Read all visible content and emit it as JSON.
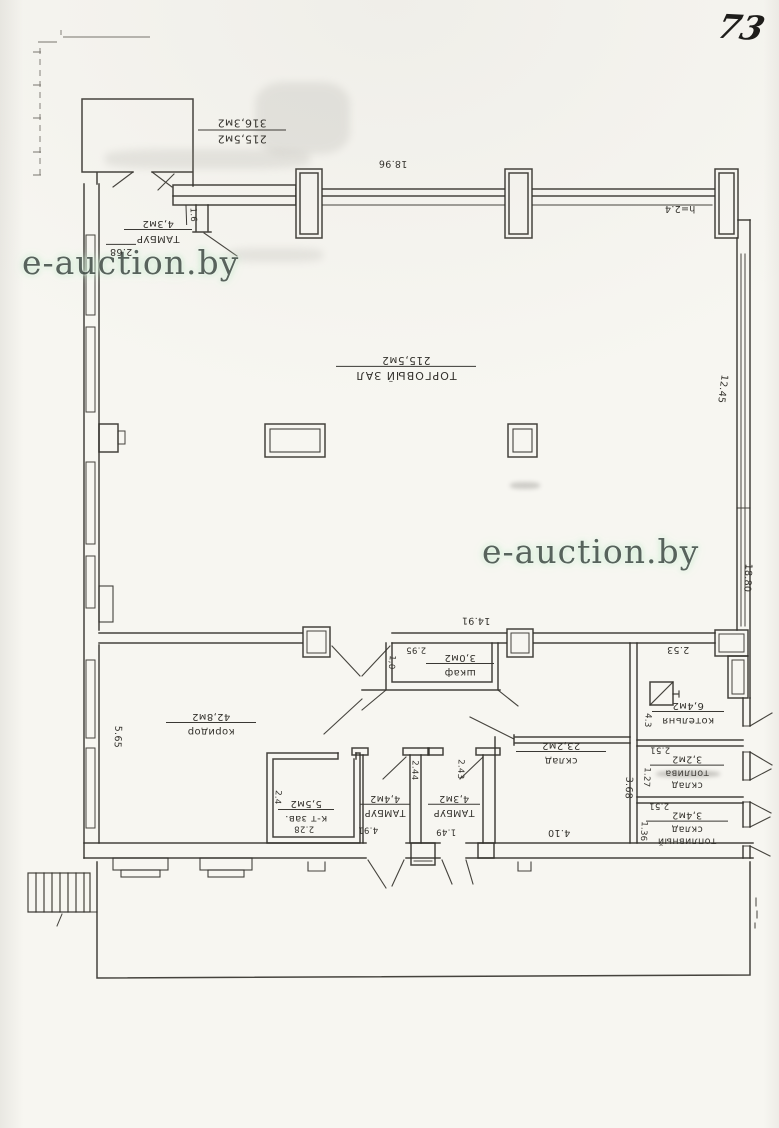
{
  "page": {
    "number": "73"
  },
  "watermark": {
    "text": "e-auction.by"
  },
  "plan": {
    "summary": {
      "hall_area": "215,5м2",
      "total_area": "316,3м2"
    },
    "rooms": {
      "trading_hall": {
        "name": "ТОРГОВЫЙ ЗАЛ",
        "area": "215,5м2"
      },
      "tambour_top": {
        "name": "ТАМБУР",
        "area": "4,3м2"
      },
      "corridor": {
        "name": "коридор",
        "area": "42,8м2"
      },
      "office": {
        "name": "к-т зав.",
        "area": "5,5м2"
      },
      "tambour_left": {
        "name": "ТАМБУР",
        "area": "4,4м2"
      },
      "tambour_right": {
        "name": "ТАМБУР",
        "area": "4,3м2"
      },
      "wardrobe": {
        "name": "шкаф",
        "area": "3,0м2"
      },
      "storage": {
        "name": "склад",
        "area": "23,2м2"
      },
      "boiler_room": {
        "name": "котельня",
        "area": "6,4м2"
      },
      "fuel_storage_1": {
        "name_line1": "склад",
        "name_line2": "топлива",
        "area": "3,2м2"
      },
      "fuel_storage_2": {
        "name_line1": "топливный",
        "name_line2": "склад",
        "area": "3,4м2"
      }
    },
    "dimensions": {
      "top_wall": "18.96",
      "ceiling_height": "h=2.4",
      "right_upper": "12.45",
      "right_lower": "18.80",
      "left_wall": "5.65",
      "tambour_top_width": "2.68",
      "wall_tick": "1.6",
      "inner_wall": "14.91",
      "wardrobe_width": "2.95",
      "wardrobe_depth": "1,0",
      "storage_width": "4.10",
      "storage_side": "3.68",
      "corridor_segment": "4.91",
      "tambour_left_depth": "2.44",
      "tambour_right_depth": "2.43",
      "tambour_right_width": "1.49",
      "office_width": "2.28",
      "office_depth": "2.4",
      "boiler_top": "2.53",
      "boiler_side": "4.3",
      "boiler_bottom": "2.51",
      "fuel1_side": "1.27",
      "fuel1_bottom": "2.51",
      "fuel2_side": "1.36"
    }
  }
}
